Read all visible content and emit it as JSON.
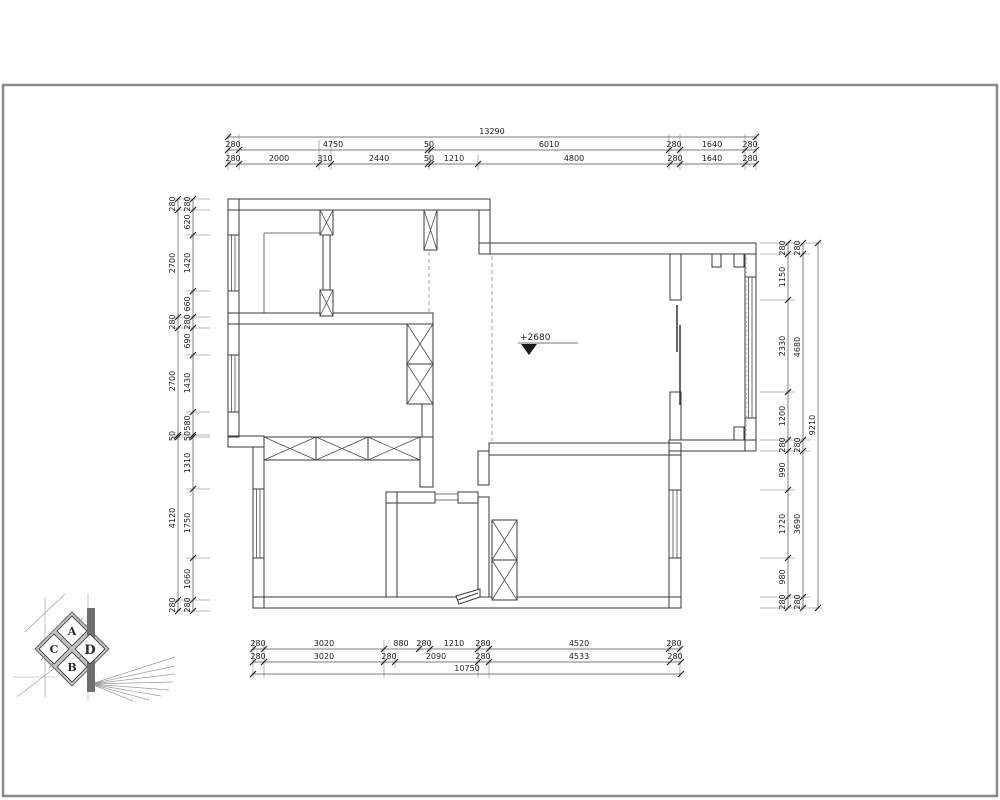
{
  "drawing": {
    "type": "floor-plan",
    "annotation": {
      "level": "+2680"
    },
    "colors": {
      "wall_line": "#3a3a3a",
      "dimension_line": "#4c4c4c",
      "dashed_opening": "#9a9a9a",
      "sheet_frame": "#8a8a8a",
      "background": "#ffffff"
    }
  },
  "dims": {
    "top": {
      "total": "13290",
      "row1": [
        "280",
        "4750",
        "50",
        "6010",
        "280",
        "1640",
        "280"
      ],
      "row2": [
        "280",
        "2000",
        "310",
        "2440",
        "50",
        "1210",
        "4800",
        "280",
        "1640",
        "280"
      ]
    },
    "left": {
      "outer": [
        "280",
        "2700",
        "280",
        "2700",
        "50",
        "4120",
        "280"
      ],
      "inner": [
        "280",
        "620",
        "1420",
        "660",
        "280",
        "690",
        "1430",
        "580",
        "50",
        "1310",
        "1750",
        "1060",
        "280"
      ]
    },
    "right": {
      "col1": [
        "280",
        "1150",
        "2330",
        "1200",
        "280",
        "990",
        "1720",
        "980",
        "280"
      ],
      "col2": [
        "280",
        "4680",
        "280",
        "3690",
        "280"
      ],
      "total": "9210"
    },
    "bottom": {
      "row1": [
        "280",
        "3020",
        "880",
        "280",
        "1210",
        "280",
        "4520",
        "280"
      ],
      "row2": [
        "280",
        "3020",
        "280",
        "2090",
        "280",
        "4533",
        "280"
      ],
      "total": "10750"
    }
  },
  "logo": {
    "letters": {
      "top": "A",
      "left": "C",
      "right": "D",
      "bottom": "B"
    }
  }
}
